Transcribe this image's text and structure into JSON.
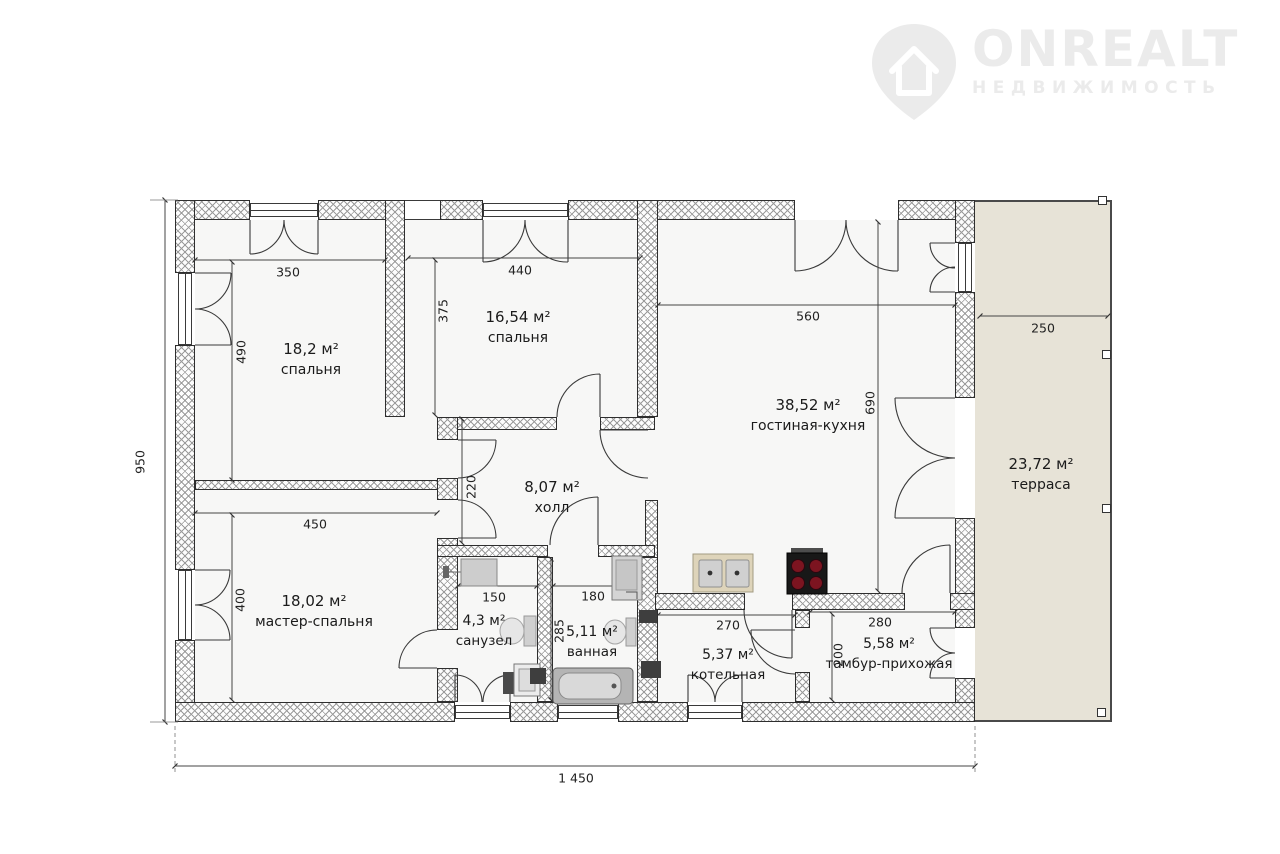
{
  "logo": {
    "brand": "ONREALT",
    "tagline": "НЕДВИЖИМОСТЬ"
  },
  "rooms": {
    "bedroom1": {
      "area": "18,2 м²",
      "name": "спальня"
    },
    "bedroom2": {
      "area": "16,54 м²",
      "name": "спальня"
    },
    "living": {
      "area": "38,52 м²",
      "name": "гостиная-кухня"
    },
    "hall": {
      "area": "8,07 м²",
      "name": "холл"
    },
    "master": {
      "area": "18,02 м²",
      "name": "мастер-спальня"
    },
    "wc": {
      "area": "4,3 м²",
      "name": "санузел"
    },
    "bath": {
      "area": "5,11 м²",
      "name": "ванная"
    },
    "boiler": {
      "area": "5,37 м²",
      "name": "котельная"
    },
    "vestibule": {
      "area": "5,58 м²",
      "name": "тамбур-прихожая"
    },
    "terrace": {
      "area": "23,72 м²",
      "name": "терраса"
    }
  },
  "dimensions": {
    "bedroom1_width": "350",
    "bedroom1_height": "490",
    "bedroom2_width": "440",
    "bedroom2_height": "375",
    "living_width": "560",
    "living_height": "690",
    "master_width": "450",
    "master_height": "400",
    "hall_height": "220",
    "wc_width": "150",
    "bath_width": "180",
    "bath_height": "285",
    "boiler_width": "270",
    "vestibule_width": "280",
    "vestibule_height": "200",
    "terrace_width": "250",
    "overall_height": "950",
    "overall_width": "1 450"
  },
  "colors": {
    "wall_hatch": "#9b9b9b",
    "line": "#3a3a3a",
    "terrace_fill": "#e7e3d7",
    "stove_body": "#181818",
    "burner_red": "#7c1420",
    "logo_gray": "#ebebeb",
    "floor": "#f7f7f6"
  }
}
